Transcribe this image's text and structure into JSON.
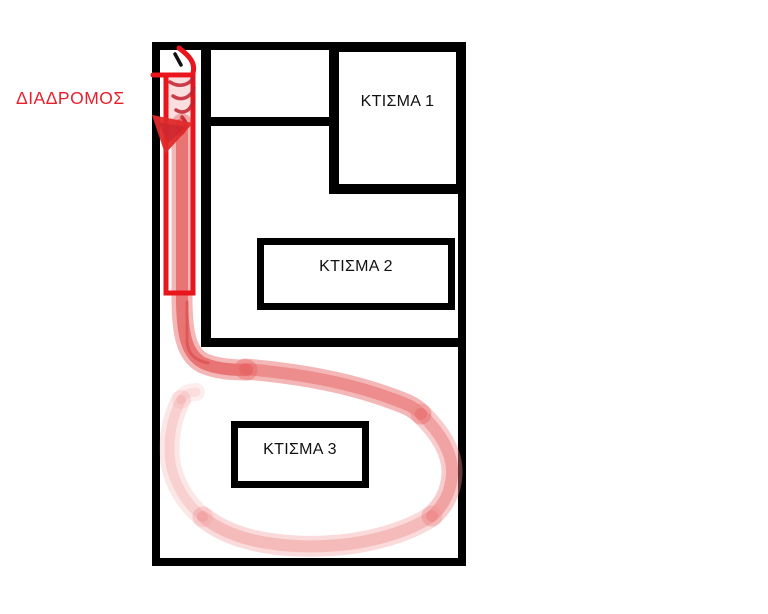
{
  "plan": {
    "corridor_label": "ΔΙΑΔΡΟΜΟΣ",
    "buildings": [
      {
        "id": 1,
        "label": "ΚΤΙΣΜΑ 1"
      },
      {
        "id": 2,
        "label": "ΚΤΙΣΜΑ 2"
      },
      {
        "id": 3,
        "label": "ΚΤΙΣΜΑ 3"
      }
    ],
    "annotations": {
      "highlighted_area_label": "ΔΙΑΔΡΟΜΟΣ",
      "route_description": "red arrow down the corridor, path turns right and loops around ΚΤΙΣΜΑ 3"
    },
    "colors": {
      "wall": "#000000",
      "marker_red": "#e8161c",
      "brush_red": "#e55f5f",
      "label_red": "#e8202c",
      "label_black": "#111111"
    }
  }
}
